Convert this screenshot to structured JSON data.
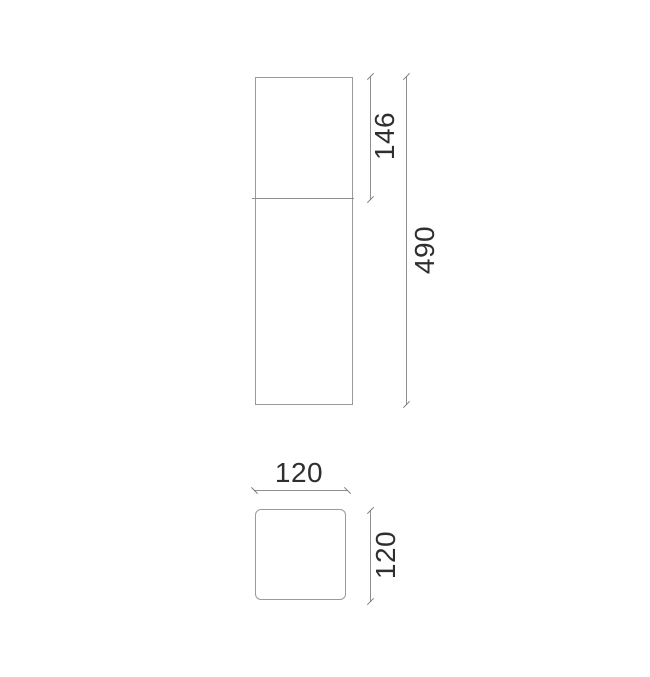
{
  "drawing": {
    "type": "technical-dimension-drawing",
    "colors": {
      "outline_line": "#9a9a9a",
      "dimension_line": "#8f8f8f",
      "tick": "#7a7a7a",
      "text": "#2f2f2f",
      "background": "#ffffff"
    },
    "front_view": {
      "dimensions": {
        "head_height": "146",
        "total_height": "490"
      }
    },
    "top_view": {
      "dimensions": {
        "width": "120",
        "depth": "120"
      }
    }
  }
}
